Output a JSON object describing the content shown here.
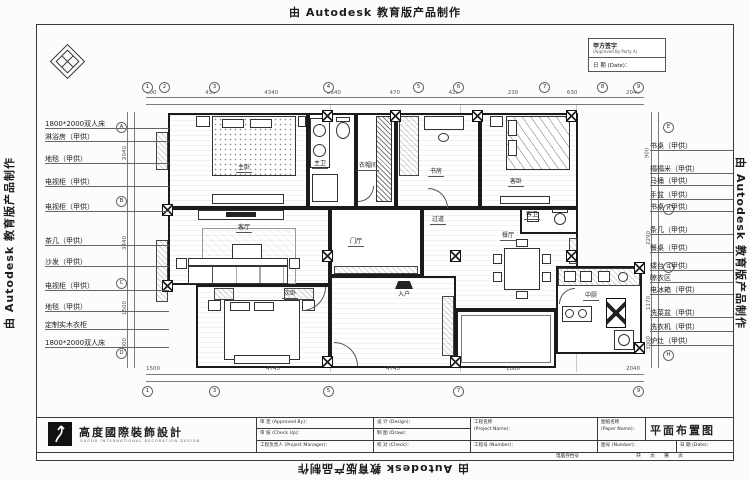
{
  "watermark": {
    "text": "由 Autodesk 教育版产品制作"
  },
  "stamp": {
    "sign_cn": "甲方签字",
    "sign_en": "(Approved By Party A)",
    "date": "日 期 (Date)："
  },
  "left_labels": [
    "1800*2000双人床",
    "淋浴房（甲供）",
    "地毯（甲供）",
    "电视柜（甲供）",
    "电视柜（甲供）",
    "茶几（甲供）",
    "沙发（甲供）",
    "电视柜（甲供）",
    "地毯（甲供）",
    "定制实木衣柜",
    "1800*2000双人床"
  ],
  "right_labels": [
    "书桌（甲供）",
    "榻榻米（甲供）",
    "马桶（甲供）",
    "手盆（甲供）",
    "书桌（甲供）",
    "条几（甲供）",
    "餐桌（甲供）",
    "矮台（甲供）",
    "晾衣区",
    "电冰箱（甲供）",
    "洗菜盆（甲供）",
    "洗衣机（甲供）",
    "炉灶（甲供）"
  ],
  "rooms": {
    "master_bedroom": "主卧",
    "master_bath": "主卫",
    "cloakroom": "衣帽间",
    "study": "书房",
    "guest_bedroom": "客卧",
    "hallway": "过道",
    "guest_bath": "客卫",
    "dining": "餐厅",
    "kitchen": "中厨",
    "second_bedroom": "次卧",
    "living": "客厅",
    "foyer": "门厅",
    "entry": "入户"
  },
  "dims": {
    "top": [
      "500",
      "430",
      "4340",
      "2640",
      "470",
      "420",
      "230",
      "630",
      "2040"
    ],
    "bottom": [
      "1500",
      "4745",
      "4745",
      "1080",
      "2040"
    ],
    "left": [
      "2040",
      "3440",
      "1500",
      "1000"
    ],
    "right": [
      "900",
      "2290",
      "1170",
      "3000"
    ]
  },
  "axes": {
    "top": [
      "1",
      "2",
      "3",
      "4",
      "5",
      "6",
      "7",
      "8",
      "9"
    ],
    "left": [
      "A",
      "B",
      "C",
      "D"
    ],
    "right": [
      "E",
      "F",
      "G",
      "H"
    ]
  },
  "titleblock": {
    "logo_text": "高度國際裝飾設計",
    "logo_sub": "GAODU INTERNATIONAL DECORATION DESIGN",
    "approved": "审 定 (Approved By)：",
    "check": "审 核 (Check Up)：",
    "pm": "工程负责人 (Project Manager)：",
    "design": "设 计 (Design)：",
    "draw": "制 图 (Draw)：",
    "proof": "校 对 (Check)：",
    "project_name": "工程名称",
    "project_name_en": "(Project Name)：",
    "project_no": "工程号 (Number)：",
    "paper_name": "图纸名称",
    "paper_name_en": "(Paper Name)：",
    "paper_no": "图号 (Number)：",
    "date": "日 期 (Date)：",
    "drawing_title": "平面布置图",
    "archive": "电脑存档号",
    "pages": "共　页　第　页"
  }
}
